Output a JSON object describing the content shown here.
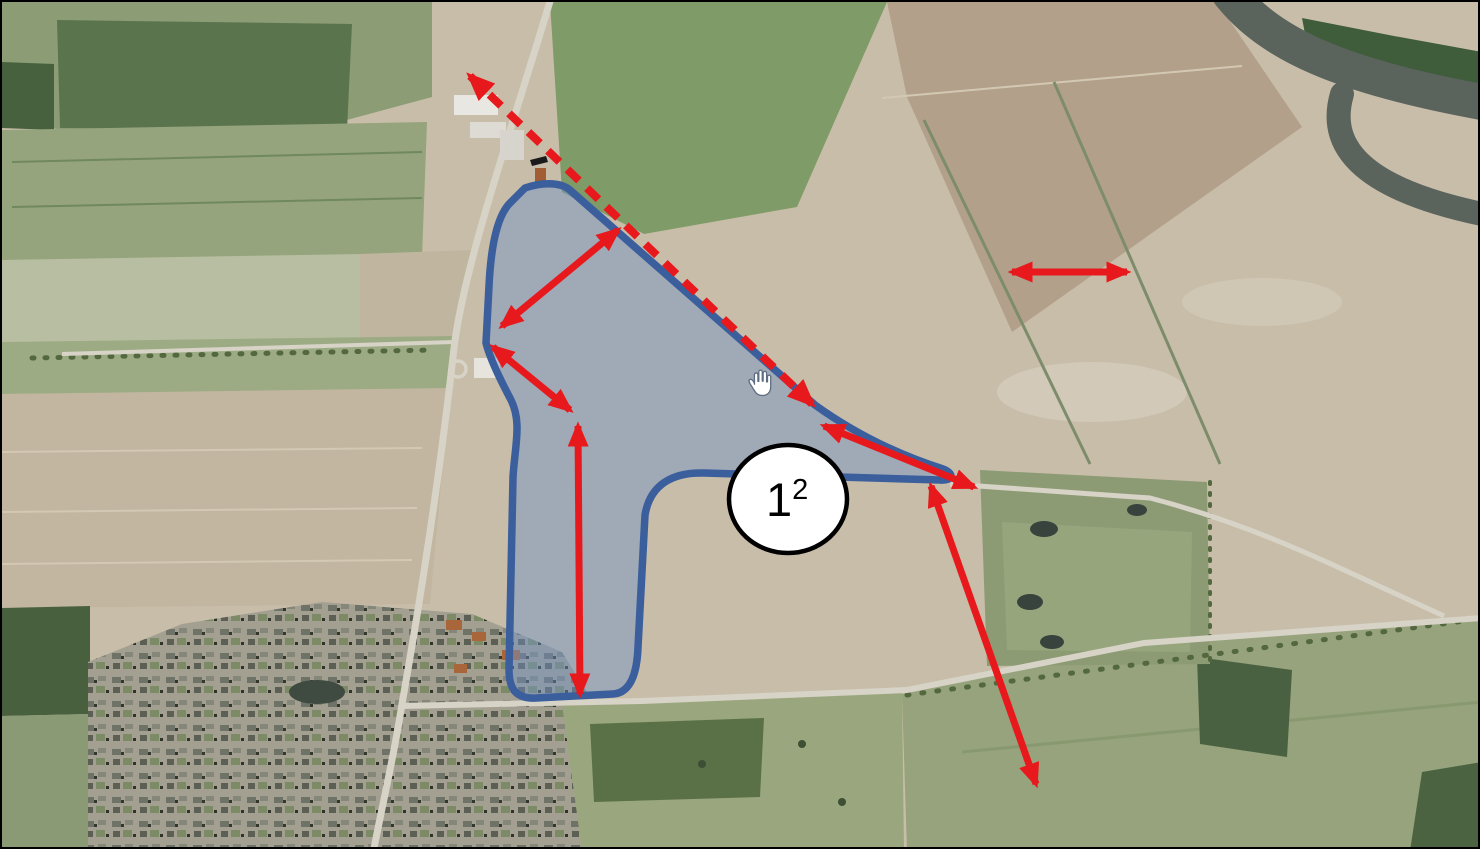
{
  "colors": {
    "arrow-red": "#e8191c",
    "area-stroke": "#3b5e9d",
    "area-fill": "rgba(110,145,198,0.45)",
    "circle-fill": "#ffffff",
    "circle-stroke": "#000000",
    "label-color": "#000000"
  },
  "annotations": {
    "area_label": {
      "base": "1",
      "superscript": "2"
    },
    "hand_cursor": "open-hand-pan-cursor",
    "highlighted_area": {
      "path": "M 523,186 C 543,179 561,181 569,189 L 813,403 C 866,441 916,459 941,467 C 952,471 952,479 938,478 L 702,471 C 670,470 648,483 643,513 L 636,645 C 635,673 628,691 611,692 L 534,696 C 515,697 507,688 507,668 L 511,475 C 513,443 520,420 509,398 C 500,381 488,357 484,341 L 487,284 C 489,242 496,212 509,200 Z"
    },
    "arrows": [
      {
        "id": "sightline-arrow-dashed",
        "style": "dashed",
        "x1": 468,
        "y1": 74,
        "x2": 810,
        "y2": 402
      },
      {
        "id": "width-arrow-upper-left",
        "style": "solid",
        "x1": 616,
        "y1": 228,
        "x2": 500,
        "y2": 324
      },
      {
        "id": "width-arrow-left",
        "style": "solid",
        "x1": 491,
        "y1": 345,
        "x2": 568,
        "y2": 408
      },
      {
        "id": "length-arrow-vertical",
        "style": "solid",
        "x1": 576,
        "y1": 424,
        "x2": 578,
        "y2": 692
      },
      {
        "id": "width-arrow-arm",
        "style": "solid",
        "x1": 822,
        "y1": 424,
        "x2": 972,
        "y2": 485
      },
      {
        "id": "length-arrow-southeast",
        "style": "solid",
        "x1": 929,
        "y1": 484,
        "x2": 1034,
        "y2": 782
      },
      {
        "id": "width-arrow-field-right",
        "style": "solid",
        "x1": 1010,
        "y1": 270,
        "x2": 1125,
        "y2": 270
      }
    ]
  }
}
